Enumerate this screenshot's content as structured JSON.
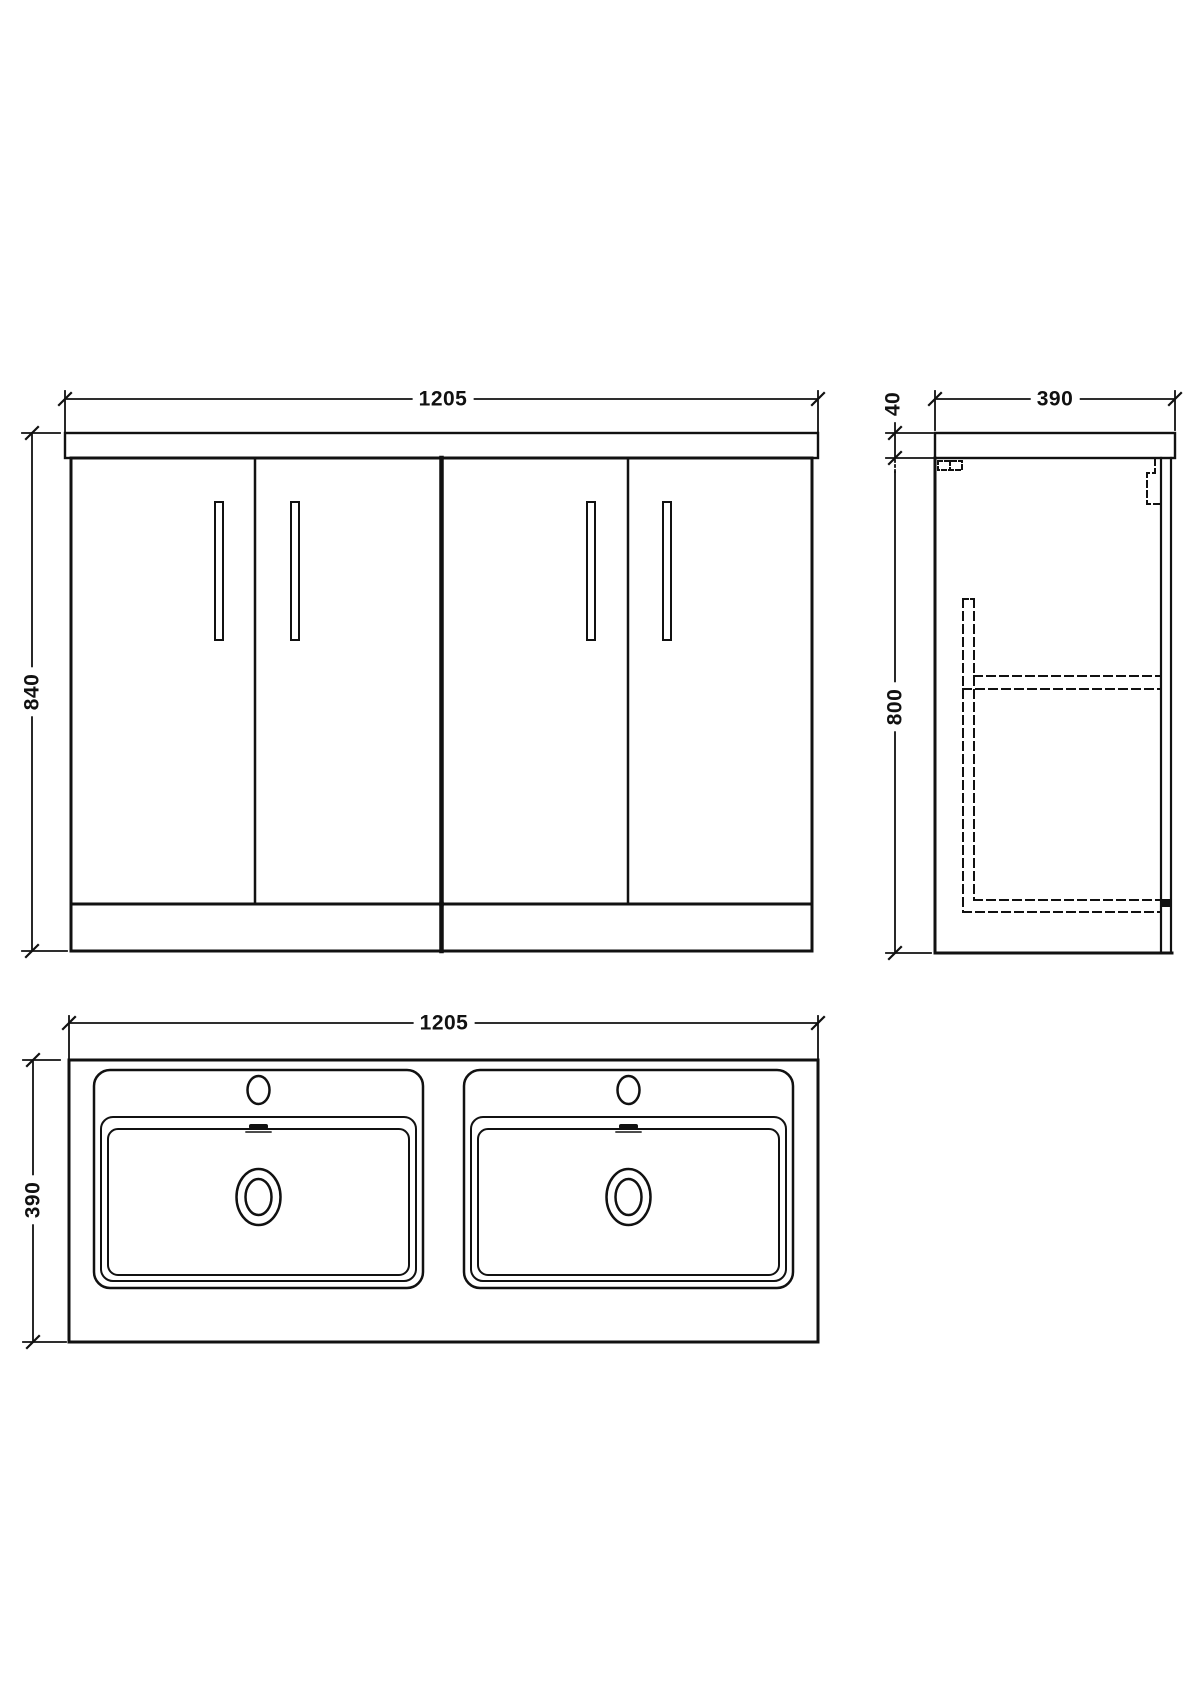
{
  "drawing": {
    "subject": "double-basin-vanity-unit-technical-drawing",
    "background_color": "#ffffff",
    "line_color": "#111111"
  },
  "dims": {
    "front_width": "1205",
    "front_height": "840",
    "side_depth": "390",
    "side_counter_thickness": "40",
    "side_cabinet_height": "800",
    "plan_width": "1205",
    "plan_depth": "390"
  }
}
